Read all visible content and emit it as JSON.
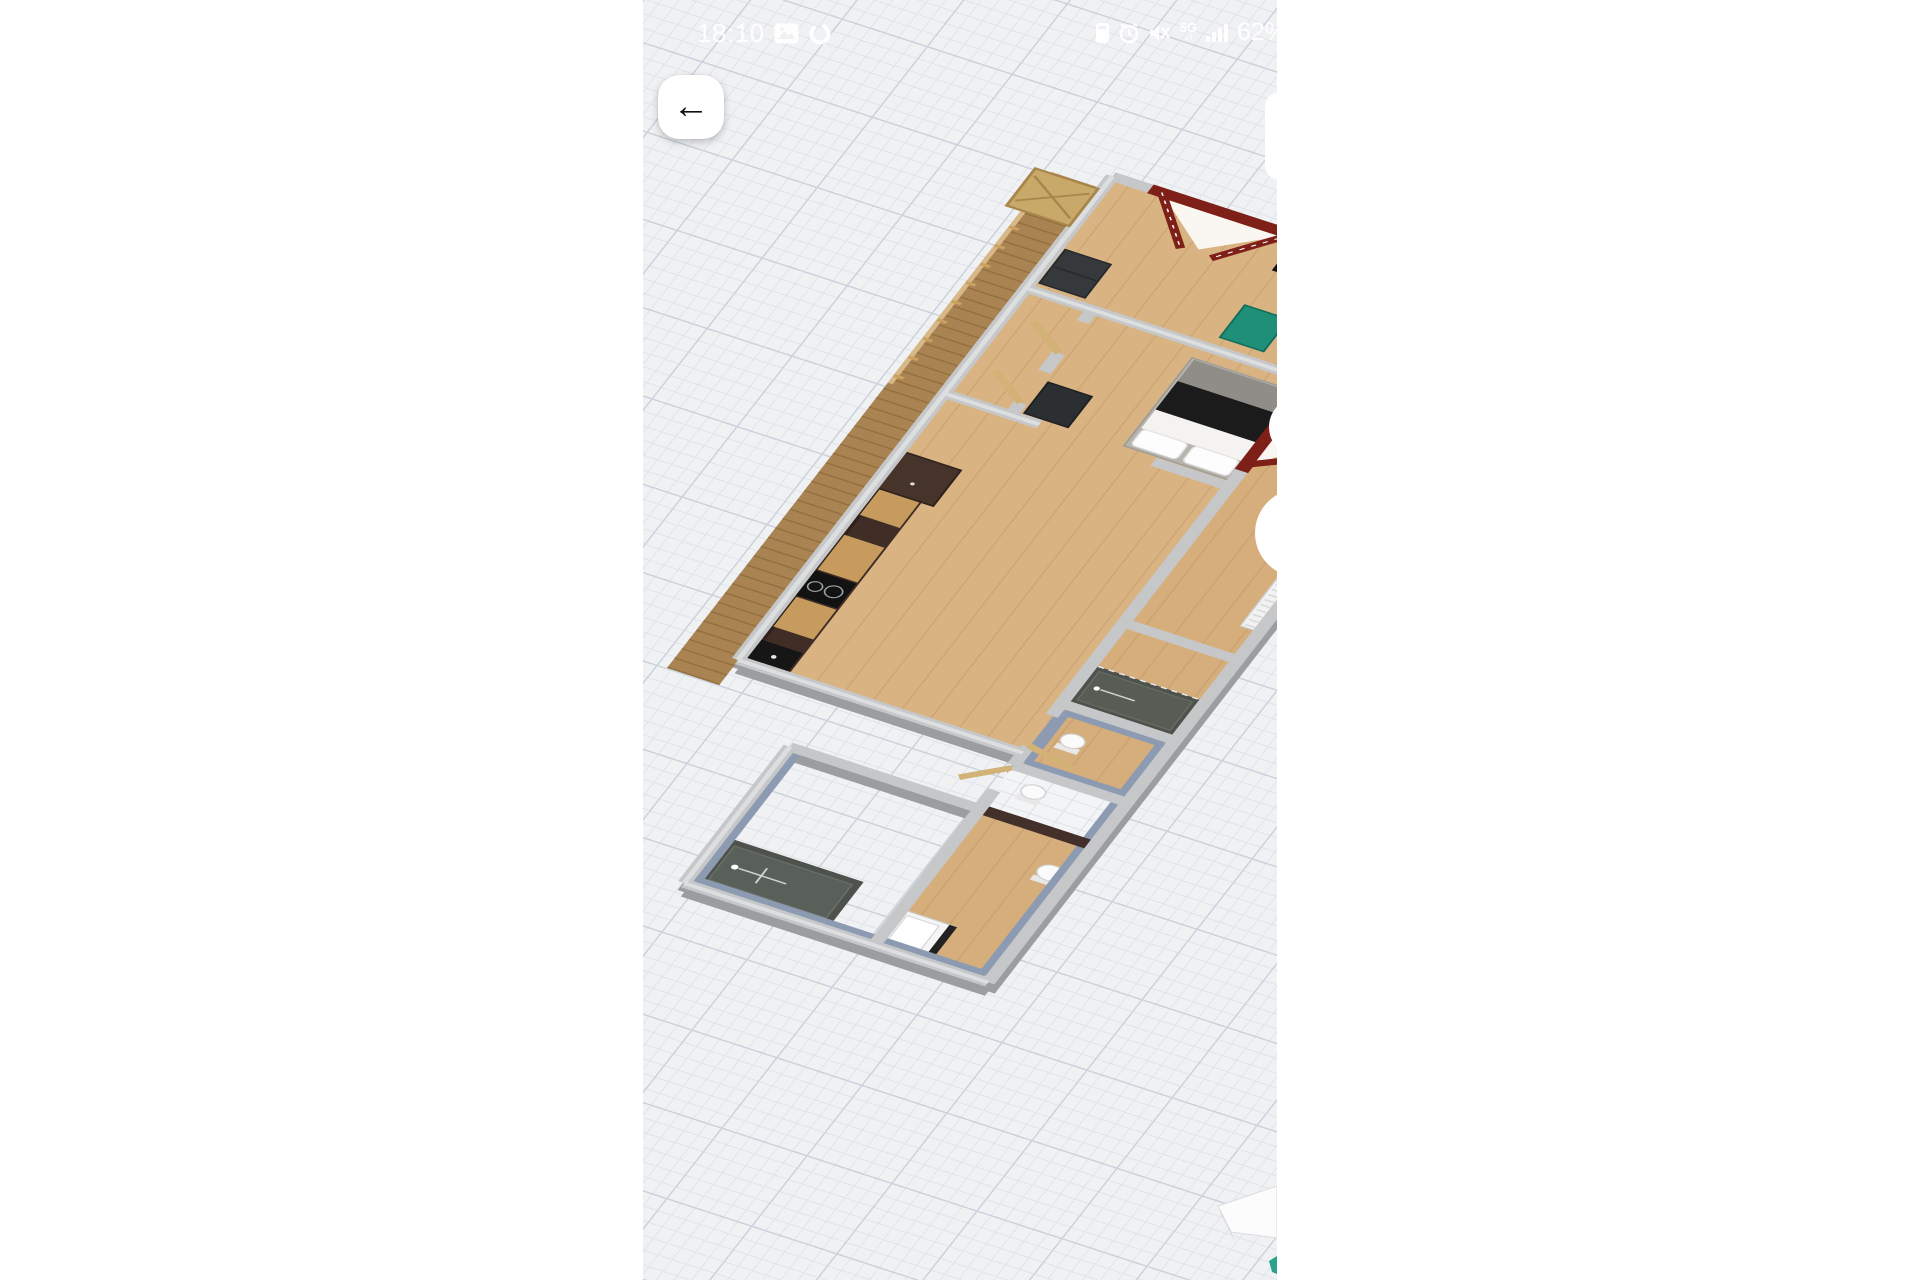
{
  "status_bar": {
    "time": "18:10",
    "battery": "62%",
    "network_label": "5G",
    "network_arrows": "↓↑",
    "left_icons": [
      "gallery-icon",
      "sync-loop-icon"
    ],
    "right_icons": [
      "phone-battery-icon",
      "alarm-icon",
      "mute-icon",
      "network-5g-indicator",
      "signal-strength-icon"
    ]
  },
  "navigation": {
    "back_glyph": "←"
  },
  "colors": {
    "canvas-bg": "#f0f1f3",
    "grid-minor": "#e0e4ea",
    "grid-major": "#ccd3dc",
    "status-fg": "#ffffff",
    "wall": "#c5c7c9",
    "wall-shadow": "#9b9ea1",
    "wall-highlight": "#dcdedf",
    "wood-floor": "#d9b382",
    "deck-wood": "#aa8352",
    "kitchen-dark": "#3f2d26",
    "counter-oak": "#c79b5e",
    "door-red": "#7e1f18",
    "door-tan": "#d2b277",
    "bath-wall-blue": "#8d9bb2",
    "shower-dark": "#4d524c",
    "bench-green": "#1f8f77",
    "compass-teal": "#2aa38c"
  }
}
